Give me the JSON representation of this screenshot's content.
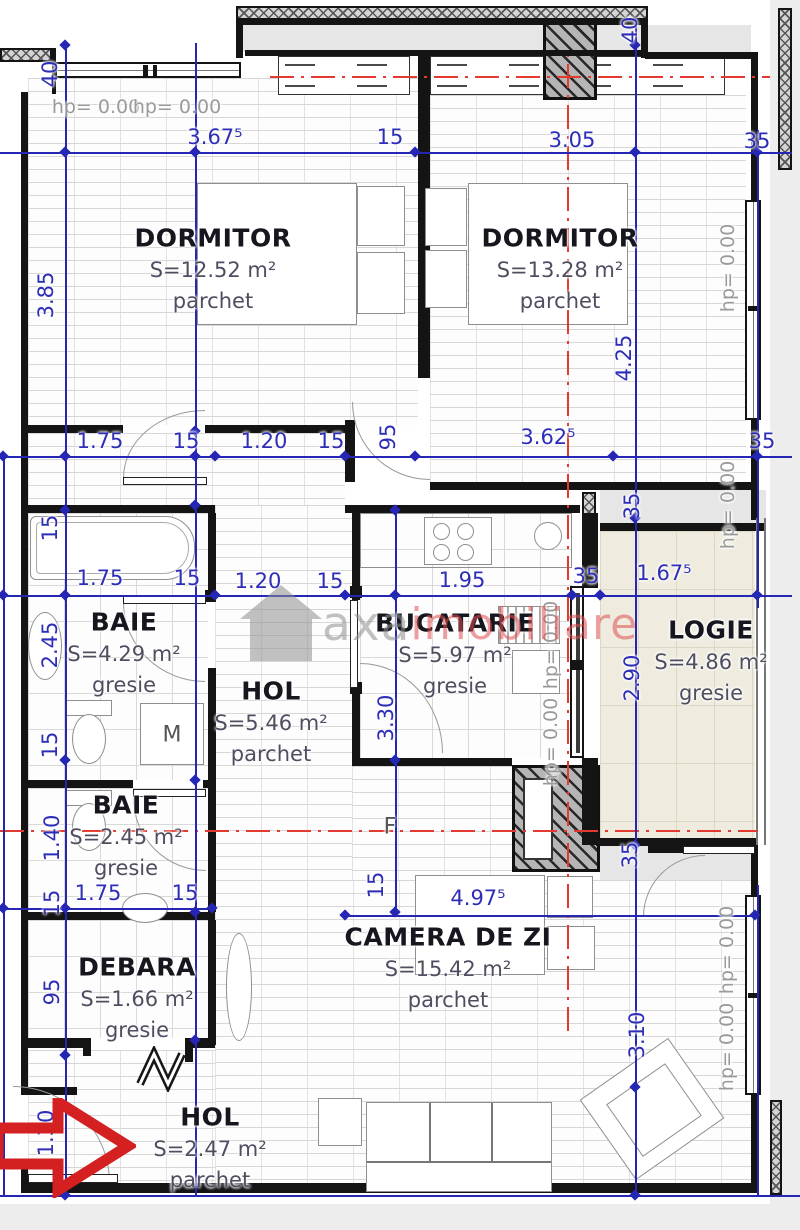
{
  "drawing": {
    "watermark": {
      "brand_gray": "axa",
      "brand_red": "imobiliare"
    },
    "rooms": [
      {
        "id": "dormitor-1",
        "name": "DORMITOR",
        "area": "S=12.52 m²",
        "floor": "parchet",
        "x": 213,
        "y": 238
      },
      {
        "id": "dormitor-2",
        "name": "DORMITOR",
        "area": "S=13.28 m²",
        "floor": "parchet",
        "x": 560,
        "y": 238
      },
      {
        "id": "baie-1",
        "name": "BAIE",
        "area": "S=4.29 m²",
        "floor": "gresie",
        "x": 124,
        "y": 622
      },
      {
        "id": "hol-1",
        "name": "HOL",
        "area": "S=5.46 m²",
        "floor": "parchet",
        "x": 271,
        "y": 691
      },
      {
        "id": "bucatarie",
        "name": "BUCATARIE",
        "area": "S=5.97 m²",
        "floor": "gresie",
        "x": 455,
        "y": 623
      },
      {
        "id": "logie",
        "name": "LOGIE",
        "area": "S=4.86 m²",
        "floor": "gresie",
        "x": 711,
        "y": 630
      },
      {
        "id": "baie-2",
        "name": "BAIE",
        "area": "S=2.45 m²",
        "floor": "gresie",
        "x": 126,
        "y": 805
      },
      {
        "id": "debara",
        "name": "DEBARA",
        "area": "S=1.66 m²",
        "floor": "gresie",
        "x": 137,
        "y": 967
      },
      {
        "id": "camera-de-zi",
        "name": "CAMERA DE ZI",
        "area": "S=15.42 m²",
        "floor": "parchet",
        "x": 448,
        "y": 937
      },
      {
        "id": "hol-2",
        "name": "HOL",
        "area": "S=2.47 m²",
        "floor": "parchet",
        "x": 210,
        "y": 1117
      }
    ],
    "dim_labels": [
      {
        "text": "3.67⁵",
        "x": 215,
        "y": 137
      },
      {
        "text": "15",
        "x": 390,
        "y": 137
      },
      {
        "text": "3.05",
        "x": 572,
        "y": 140
      },
      {
        "text": "35",
        "x": 757,
        "y": 141
      },
      {
        "text": "40",
        "x": 50,
        "y": 74,
        "r": -90
      },
      {
        "text": "40",
        "x": 630,
        "y": 30,
        "r": -90
      },
      {
        "text": "3.85",
        "x": 46,
        "y": 295,
        "r": -90
      },
      {
        "text": "4.25",
        "x": 624,
        "y": 358,
        "r": -90
      },
      {
        "text": "1.75",
        "x": 100,
        "y": 441
      },
      {
        "text": "15",
        "x": 186,
        "y": 441
      },
      {
        "text": "1.20",
        "x": 264,
        "y": 441
      },
      {
        "text": "15",
        "x": 331,
        "y": 441
      },
      {
        "text": "95",
        "x": 388,
        "y": 437,
        "r": -90
      },
      {
        "text": "3.62⁵",
        "x": 548,
        "y": 437
      },
      {
        "text": "35",
        "x": 762,
        "y": 441
      },
      {
        "text": "15",
        "x": 50,
        "y": 528,
        "r": -90
      },
      {
        "text": "35",
        "x": 632,
        "y": 506,
        "r": -90
      },
      {
        "text": "1.75",
        "x": 100,
        "y": 578
      },
      {
        "text": "15",
        "x": 187,
        "y": 578
      },
      {
        "text": "1.20",
        "x": 258,
        "y": 581
      },
      {
        "text": "15",
        "x": 330,
        "y": 581
      },
      {
        "text": "1.95",
        "x": 462,
        "y": 580
      },
      {
        "text": "35",
        "x": 586,
        "y": 576
      },
      {
        "text": "1.67⁵",
        "x": 664,
        "y": 573
      },
      {
        "text": "2.45",
        "x": 50,
        "y": 645,
        "r": -90
      },
      {
        "text": "2.90",
        "x": 632,
        "y": 678,
        "r": -90
      },
      {
        "text": "3.30",
        "x": 386,
        "y": 718,
        "r": -90
      },
      {
        "text": "15",
        "x": 50,
        "y": 745,
        "r": -90
      },
      {
        "text": "1.40",
        "x": 52,
        "y": 838,
        "r": -90
      },
      {
        "text": "15",
        "x": 52,
        "y": 903,
        "r": -90
      },
      {
        "text": "1.75",
        "x": 98,
        "y": 893
      },
      {
        "text": "15",
        "x": 185,
        "y": 893
      },
      {
        "text": "35",
        "x": 630,
        "y": 855,
        "r": -90
      },
      {
        "text": "95",
        "x": 52,
        "y": 992,
        "r": -90
      },
      {
        "text": "15",
        "x": 376,
        "y": 885,
        "r": -90
      },
      {
        "text": "4.97⁵",
        "x": 478,
        "y": 898
      },
      {
        "text": "3.10",
        "x": 637,
        "y": 1035,
        "r": -90
      },
      {
        "text": "1.30",
        "x": 46,
        "y": 1133,
        "r": -90
      }
    ],
    "hp_labels": [
      {
        "text": "hp= 0.00",
        "x": 96,
        "y": 107
      },
      {
        "text": "hp= 0.00",
        "x": 177,
        "y": 107
      },
      {
        "text": "hp= 0.00",
        "x": 728,
        "y": 268,
        "r": -90
      },
      {
        "text": "hp= 0.00",
        "x": 728,
        "y": 505,
        "r": -90
      },
      {
        "text": "hp= 0.00",
        "x": 551,
        "y": 645,
        "r": -90
      },
      {
        "text": "hp= 0.00",
        "x": 551,
        "y": 742,
        "r": -90
      },
      {
        "text": "hp= 0.00",
        "x": 727,
        "y": 950,
        "r": -90
      },
      {
        "text": "hp= 0.00",
        "x": 727,
        "y": 1047,
        "r": -90
      }
    ],
    "misc_labels": [
      {
        "text": "M",
        "x": 172,
        "y": 735
      },
      {
        "text": "F",
        "x": 390,
        "y": 827
      }
    ],
    "colors": {
      "dim_blue": "#2d2db8",
      "centerline_red": "#e23a2e",
      "arrow_red": "#d42020",
      "wall_black": "#141414",
      "room_text_gray": "#4e4e60",
      "hp_gray": "#9a9a9a",
      "logie_floor": "#efecdf"
    }
  }
}
